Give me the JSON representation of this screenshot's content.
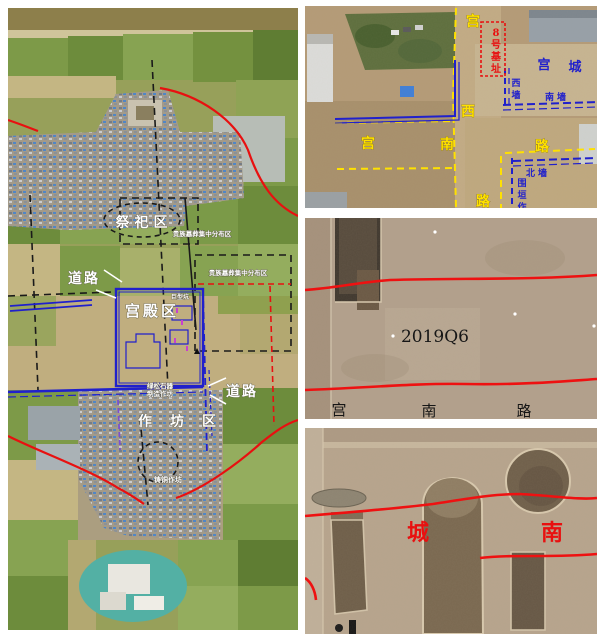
{
  "colors": {
    "annotation_red": "#e81010",
    "annotation_blue": "#2020cc",
    "annotation_yellow": "#ffe100",
    "annotation_purple": "#8b2fd6",
    "annotation_white": "#ffffff"
  },
  "site_map": {
    "sacrifice_area": "祭祀区",
    "noble_tombs_north": "贵族墓葬集中分布区",
    "noble_tombs_east": "贵族墓葬集中分布区",
    "road_west": "道路",
    "road_east": "道路",
    "palace_area": "宫殿区",
    "giant_pit": "巨型坑",
    "workshop_area": "作坊区",
    "bronze_workshop": "铸铜作坊",
    "turquoise_workshop_line1": "绿松石器",
    "turquoise_workshop_line2": "制造作坊"
  },
  "palace_city": {
    "road_west": [
      "宫",
      "西",
      "路"
    ],
    "road_south": [
      "宫",
      "南",
      "路"
    ],
    "palace_city": [
      "宫",
      "城"
    ],
    "foundation8": [
      "8",
      "号",
      "基",
      "址"
    ],
    "west_wall": [
      "西",
      "墙"
    ],
    "south_wall": "南墙",
    "north_wall": "北墙",
    "enclosure_wall": [
      "围",
      "垣",
      "作"
    ]
  },
  "excavation_road": {
    "unit_number": "2019Q6",
    "road_label": [
      "宫",
      "南",
      "路"
    ]
  },
  "excavation_city_south": {
    "label": [
      "城",
      "南"
    ]
  }
}
